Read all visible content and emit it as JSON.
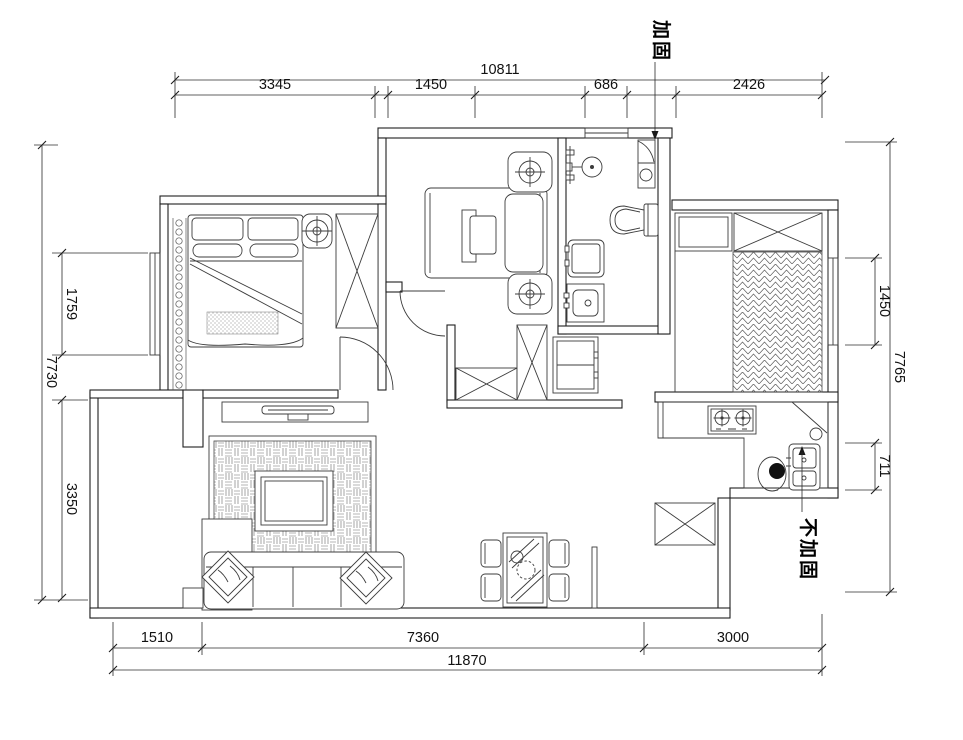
{
  "drawing": {
    "type": "floor-plan",
    "annotations": {
      "reinforce": "加固",
      "no_reinforce": "不加固"
    },
    "dimensions": {
      "top": {
        "overall": "10811",
        "segments": [
          "3345",
          "1450",
          "686",
          "2426"
        ]
      },
      "left": {
        "overall": "7730",
        "segments": [
          "1759",
          "3350"
        ]
      },
      "right": {
        "overall": "7765",
        "segments": [
          "1450",
          "711"
        ]
      },
      "bottom": {
        "overall": "11870",
        "segments": [
          "1510",
          "7360",
          "3000"
        ]
      }
    },
    "colors": {
      "line": "#1f1f1f",
      "background": "#ffffff"
    }
  }
}
